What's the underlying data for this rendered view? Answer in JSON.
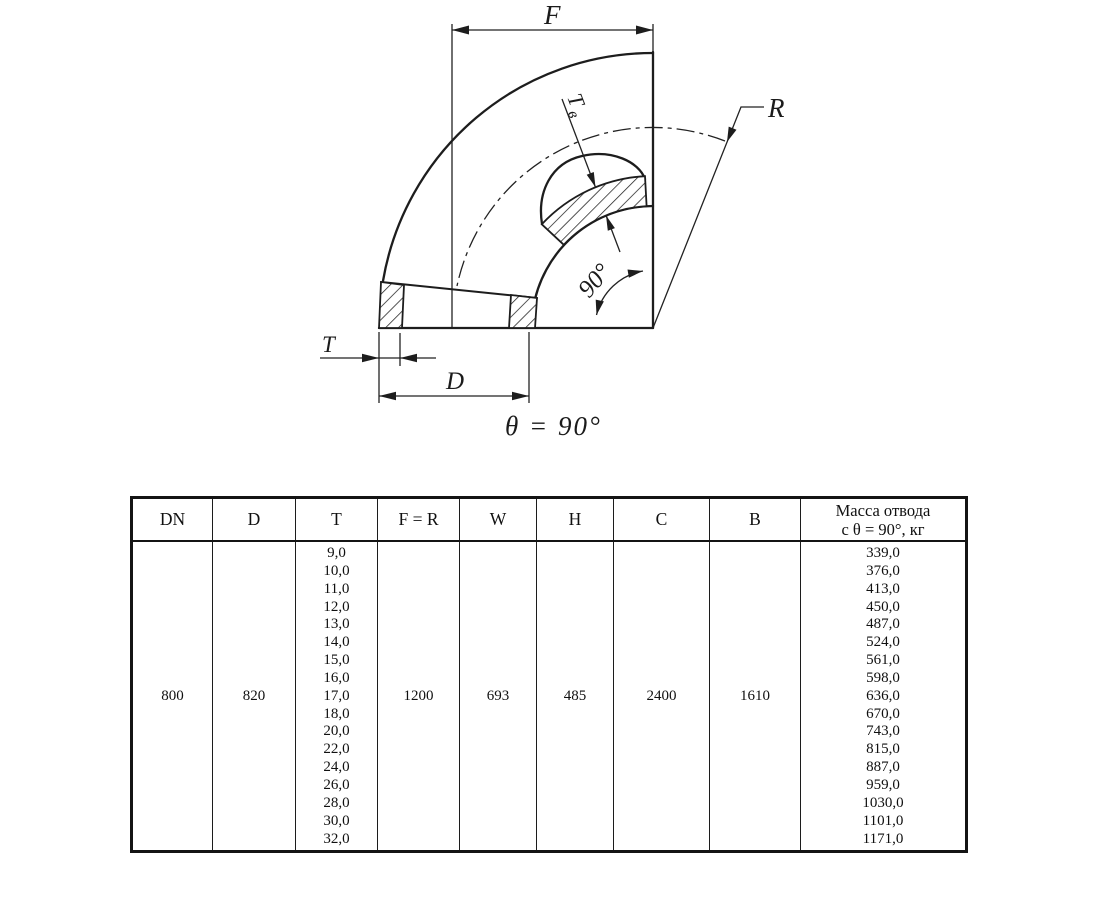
{
  "drawing": {
    "dim_f": "F",
    "dim_r": "R",
    "dim_t": "T",
    "dim_tv_main": "Т",
    "dim_tv_sub": "в",
    "dim_d": "D",
    "angle_label": "90°",
    "caption": "θ = 90°"
  },
  "table": {
    "headers": [
      "DN",
      "D",
      "T",
      "F = R",
      "W",
      "H",
      "C",
      "B"
    ],
    "mass_header_line1": "Масса отвода",
    "mass_header_line2": "с θ = 90°, кг",
    "row": {
      "dn": "800",
      "d": "820",
      "f_r": "1200",
      "w": "693",
      "h": "485",
      "c": "2400",
      "b": "1610",
      "t_values": [
        "9,0",
        "10,0",
        "11,0",
        "12,0",
        "13,0",
        "14,0",
        "15,0",
        "16,0",
        "17,0",
        "18,0",
        "20,0",
        "22,0",
        "24,0",
        "26,0",
        "28,0",
        "30,0",
        "32,0"
      ],
      "mass_values": [
        "339,0",
        "376,0",
        "413,0",
        "450,0",
        "487,0",
        "524,0",
        "561,0",
        "598,0",
        "636,0",
        "670,0",
        "743,0",
        "815,0",
        "887,0",
        "959,0",
        "1030,0",
        "1101,0",
        "1171,0"
      ]
    }
  }
}
